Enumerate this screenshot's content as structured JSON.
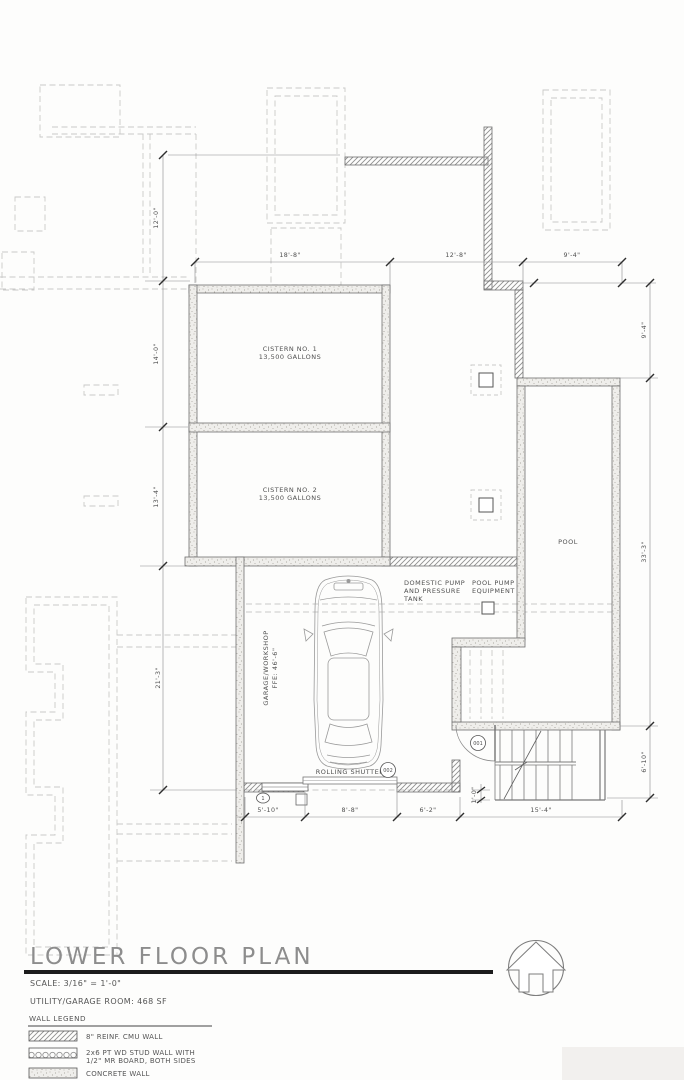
{
  "drawing": {
    "rooms": {
      "cistern1": {
        "name": "CISTERN NO. 1",
        "capacity": "13,500 GALLONS"
      },
      "cistern2": {
        "name": "CISTERN NO. 2",
        "capacity": "13,500 GALLONS"
      },
      "pool": {
        "name": "POOL"
      },
      "garage": {
        "name": "GARAGE/WORKSHOP",
        "ffe": "FFE: 46'-6\""
      }
    },
    "equipment": {
      "domestic_pump": [
        "DOMESTIC PUMP",
        "AND PRESSURE",
        "TANK"
      ],
      "pool_pump": [
        "POOL PUMP",
        "EQUIPMENT"
      ]
    },
    "shutter_label": "ROLLING SHUTTER",
    "tags": {
      "door_entry": "001",
      "door_shutter": "002",
      "window": "1"
    },
    "dims": {
      "top": [
        "18'-8\"",
        "12'-8\"",
        "9'-4\""
      ],
      "left": [
        "12'-0\"",
        "14'-0\"",
        "13'-4\"",
        "21'-3\""
      ],
      "right": [
        "9'-4\"",
        "33'-3\"",
        "6'-10\""
      ],
      "bottom": [
        "5'-10\"",
        "8'-8\"",
        "6'-2\"",
        "15'-4\""
      ],
      "jamb": "1'-0\""
    }
  },
  "title_block": {
    "title": "LOWER FLOOR PLAN",
    "scale_note": "SCALE: 3/16\" = 1'-0\"",
    "area_note": "UTILITY/GARAGE ROOM: 468 SF",
    "legend_title": "WALL LEGEND",
    "legend": [
      {
        "swatch": "diagonal-hatch",
        "lines": [
          "8\" REINF. CMU WALL",
          ""
        ]
      },
      {
        "swatch": "stud-wall",
        "lines": [
          "2x6 PT WD STUD WALL WITH",
          "1/2\" MR BOARD, BOTH SIDES"
        ]
      },
      {
        "swatch": "concrete-stipple",
        "lines": [
          "CONCRETE WALL",
          ""
        ]
      }
    ]
  },
  "colors": {
    "wall_line": "#6e6e6e",
    "dashed": "#c9c9c8",
    "text": "#4f4f4f",
    "rule": "#1c1c1c"
  }
}
